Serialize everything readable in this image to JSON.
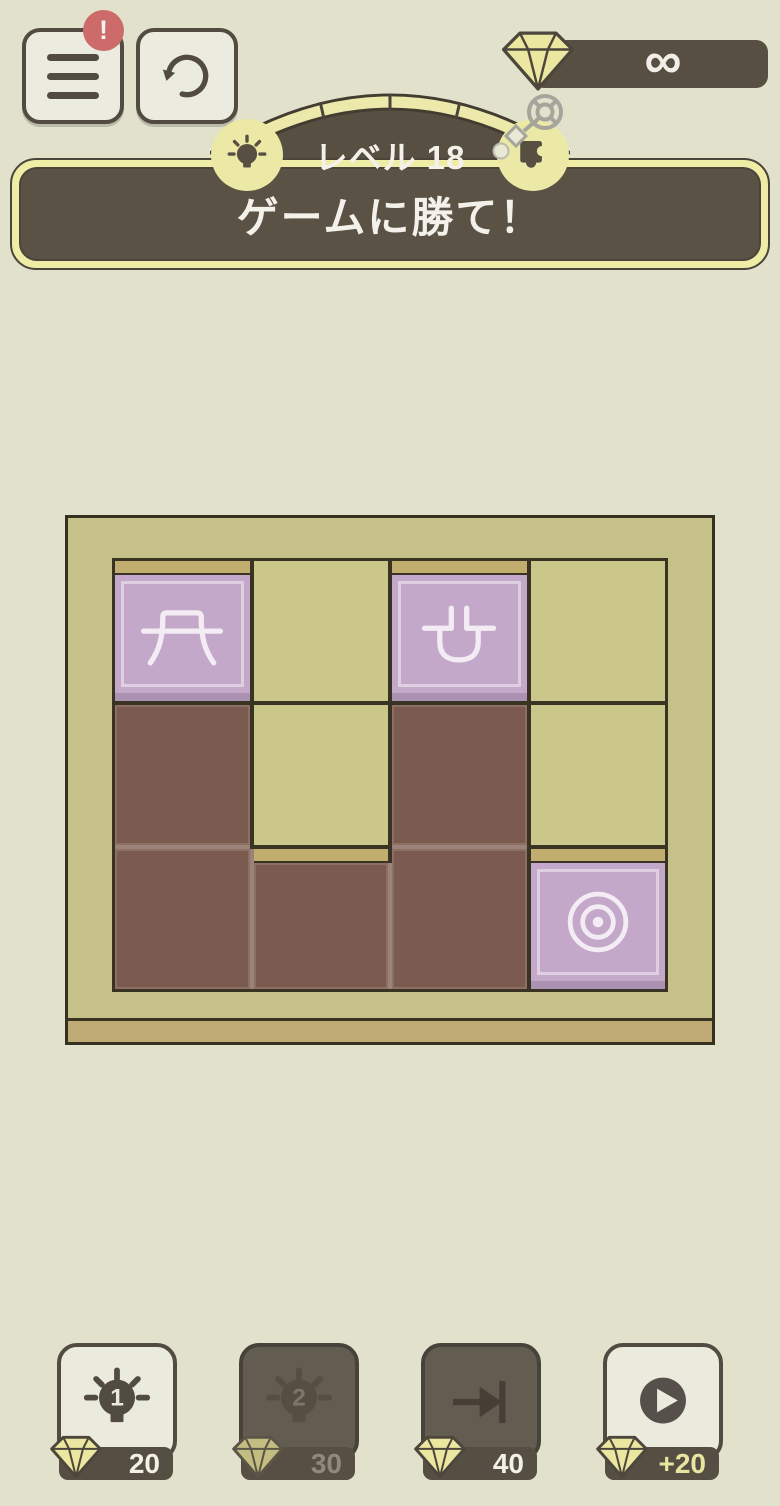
{
  "header": {
    "menu_badge": "!",
    "gem_count": "∞",
    "level_label": "レベル 18",
    "task_text": "ゲームに勝て！"
  },
  "board": {
    "columns": 4,
    "rows": 3,
    "grid": [
      [
        "piece-arch",
        "empty",
        "piece-plug",
        "empty"
      ],
      [
        "brown",
        "empty",
        "brown",
        "empty"
      ],
      [
        "brown",
        "brown",
        "brown",
        "target"
      ]
    ],
    "piece_names": {
      "piece-arch": "arch-symbol-piece",
      "piece-plug": "plug-symbol-piece",
      "brown": "block-tile",
      "target": "bullseye-target-tile"
    }
  },
  "footer": {
    "buttons": [
      {
        "label": "hint-1",
        "icon": "bulb-1-icon",
        "bulb_number": "1",
        "cost": "20",
        "state": "enabled"
      },
      {
        "label": "hint-2",
        "icon": "bulb-2-icon",
        "bulb_number": "2",
        "cost": "30",
        "state": "disabled"
      },
      {
        "label": "skip-level",
        "icon": "skip-to-end-icon",
        "cost": "40",
        "state": "dark"
      },
      {
        "label": "get-gems",
        "icon": "play-icon",
        "cost": "+20",
        "state": "enabled"
      }
    ]
  },
  "colors": {
    "background": "#e2e2cc",
    "panel_cream": "#ebebdd",
    "dark_brown": "#584f43",
    "pale_yellow": "#ece9a6",
    "badge_red": "#cd6a6a",
    "board_frame": "#c6c189",
    "cell_olive": "#cbc68a",
    "slot_tan": "#c1ad6d",
    "block_brown": "#7b5b4f",
    "piece_purple": "#c3a8c9"
  }
}
